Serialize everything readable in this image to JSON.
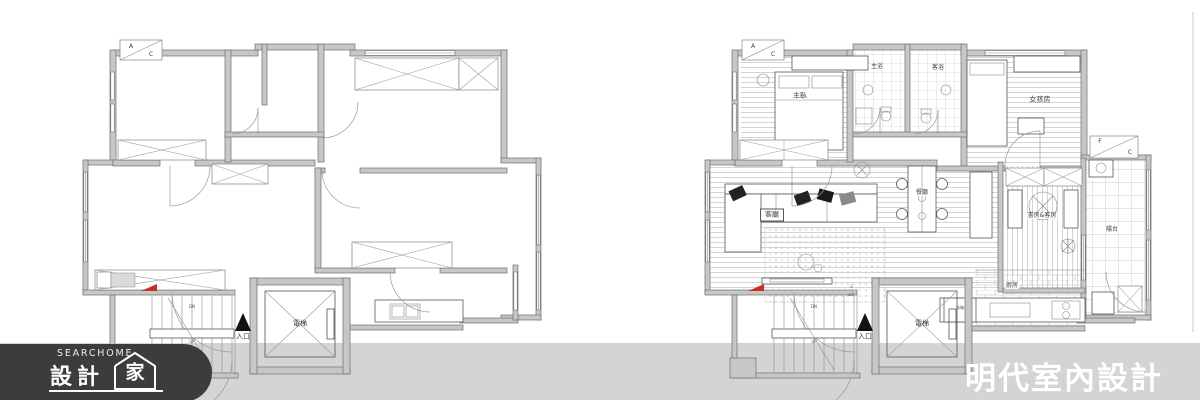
{
  "page": {
    "width": 1200,
    "height": 400,
    "background_color": "#ffffff",
    "footer_bar_color": "#d4d4d4",
    "logo_bg_color": "#3c3c3c",
    "red_marker_color": "#c53022"
  },
  "brand": {
    "logo_small_text": "SEARCHOME",
    "logo_large_text": "設計",
    "logo_house_char": "家",
    "designer_name": "明代室內設計"
  },
  "plan_before": {
    "labels": {
      "ac_top": "A",
      "ac_bottom": "C",
      "elevator": "電梯",
      "entrance": "入口",
      "stairs_down": "DN",
      "stairs_up": "UP"
    }
  },
  "plan_after": {
    "labels": {
      "ac_top": "A",
      "ac_bottom": "C",
      "fc_top": "F",
      "fc_bottom": "C",
      "master_bedroom": "主臥",
      "master_bath": "主浴",
      "guest_bath": "客浴",
      "girls_room": "女孩房",
      "living_room": "客廳",
      "dining_room": "餐廳",
      "study_guest_room": "書房&客房",
      "balcony": "陽台",
      "kitchen": "廚房",
      "fridge": "冰箱",
      "elevator": "電梯",
      "entrance": "入口",
      "stairs_down": "DN",
      "stairs_up": "UP",
      "level_low": "-2",
      "level_zero": "±0"
    }
  }
}
